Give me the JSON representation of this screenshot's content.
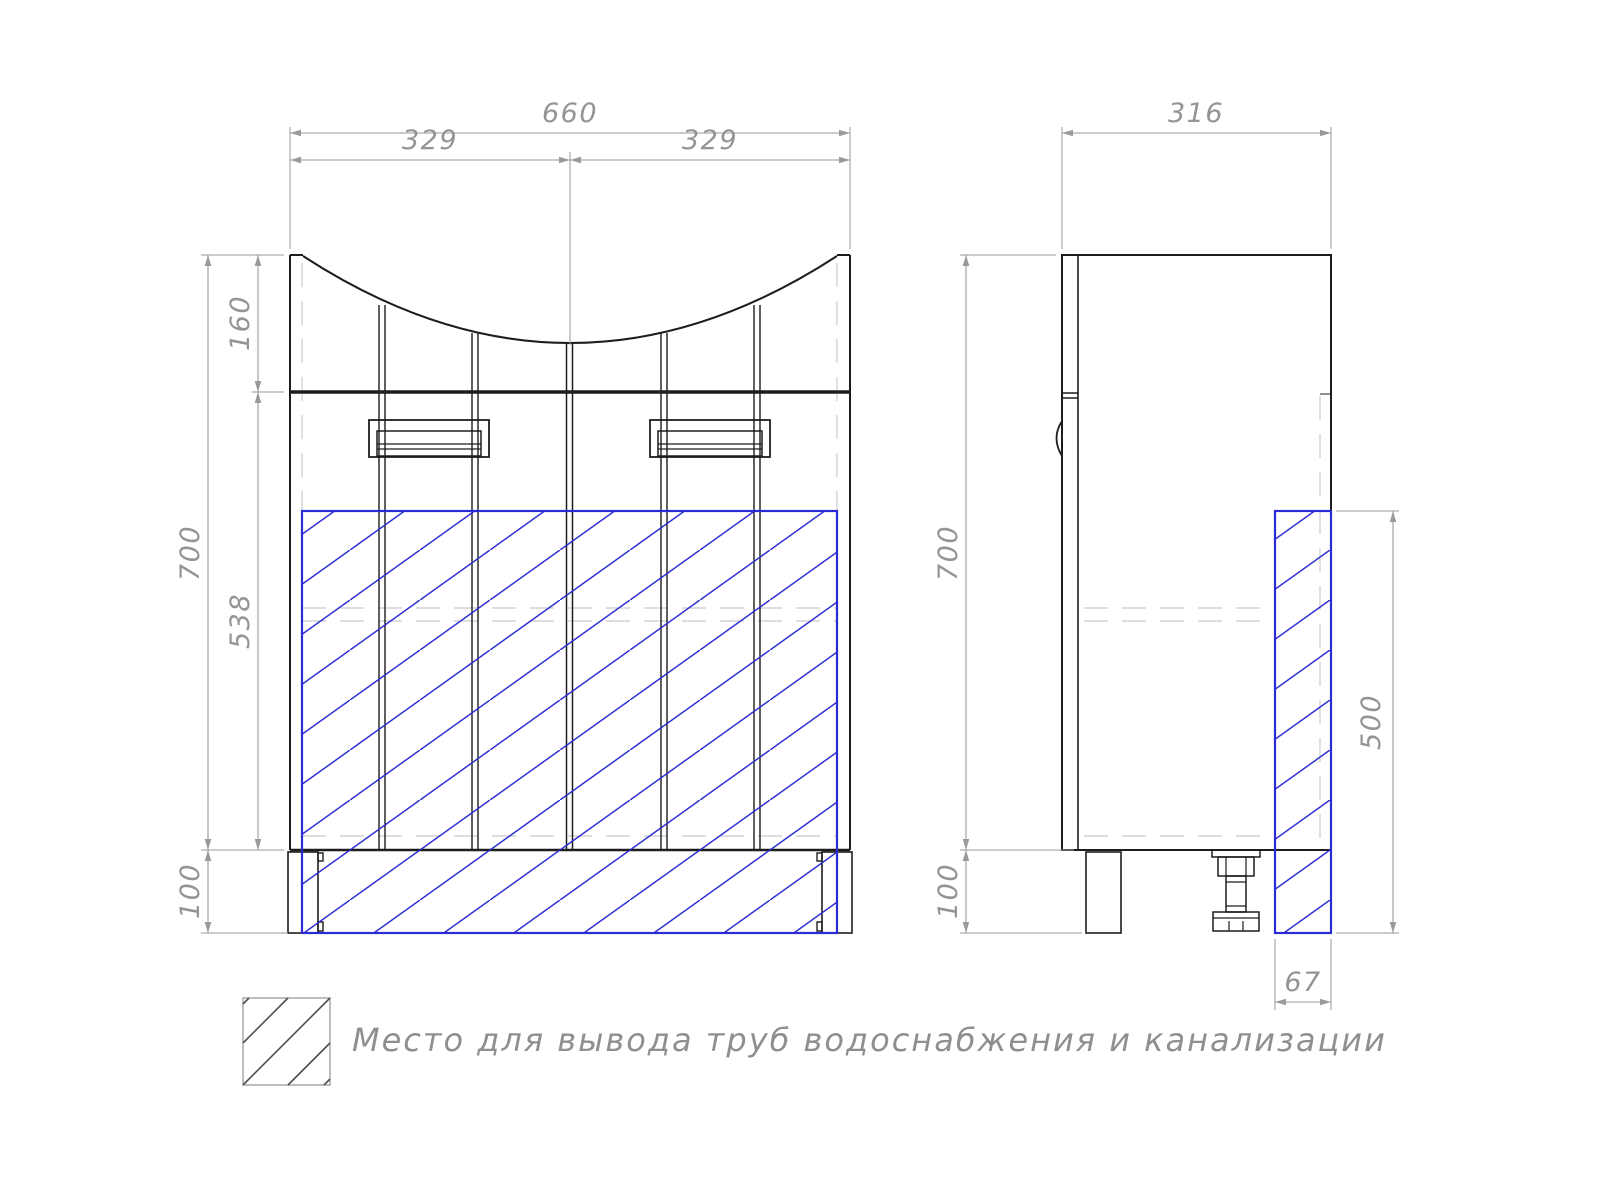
{
  "legend": {
    "label": "Место для вывода труб водоснабжения и канализации"
  },
  "front_view": {
    "dims": {
      "total_width": "660",
      "left_door_width": "329",
      "right_door_width": "329",
      "apron_height": "160",
      "body_height": "700",
      "door_height": "538",
      "leg_height": "100"
    }
  },
  "side_view": {
    "dims": {
      "depth": "316",
      "body_height": "700",
      "leg_height": "100",
      "pipe_zone_height": "500",
      "pipe_zone_depth": "67"
    }
  },
  "colors": {
    "outline": "#1d1d1d",
    "pipe_zone_blue": "#2b2bd5",
    "dimension_gray": "#9a9a9a",
    "hidden_line_gray": "#d2d2d2"
  }
}
